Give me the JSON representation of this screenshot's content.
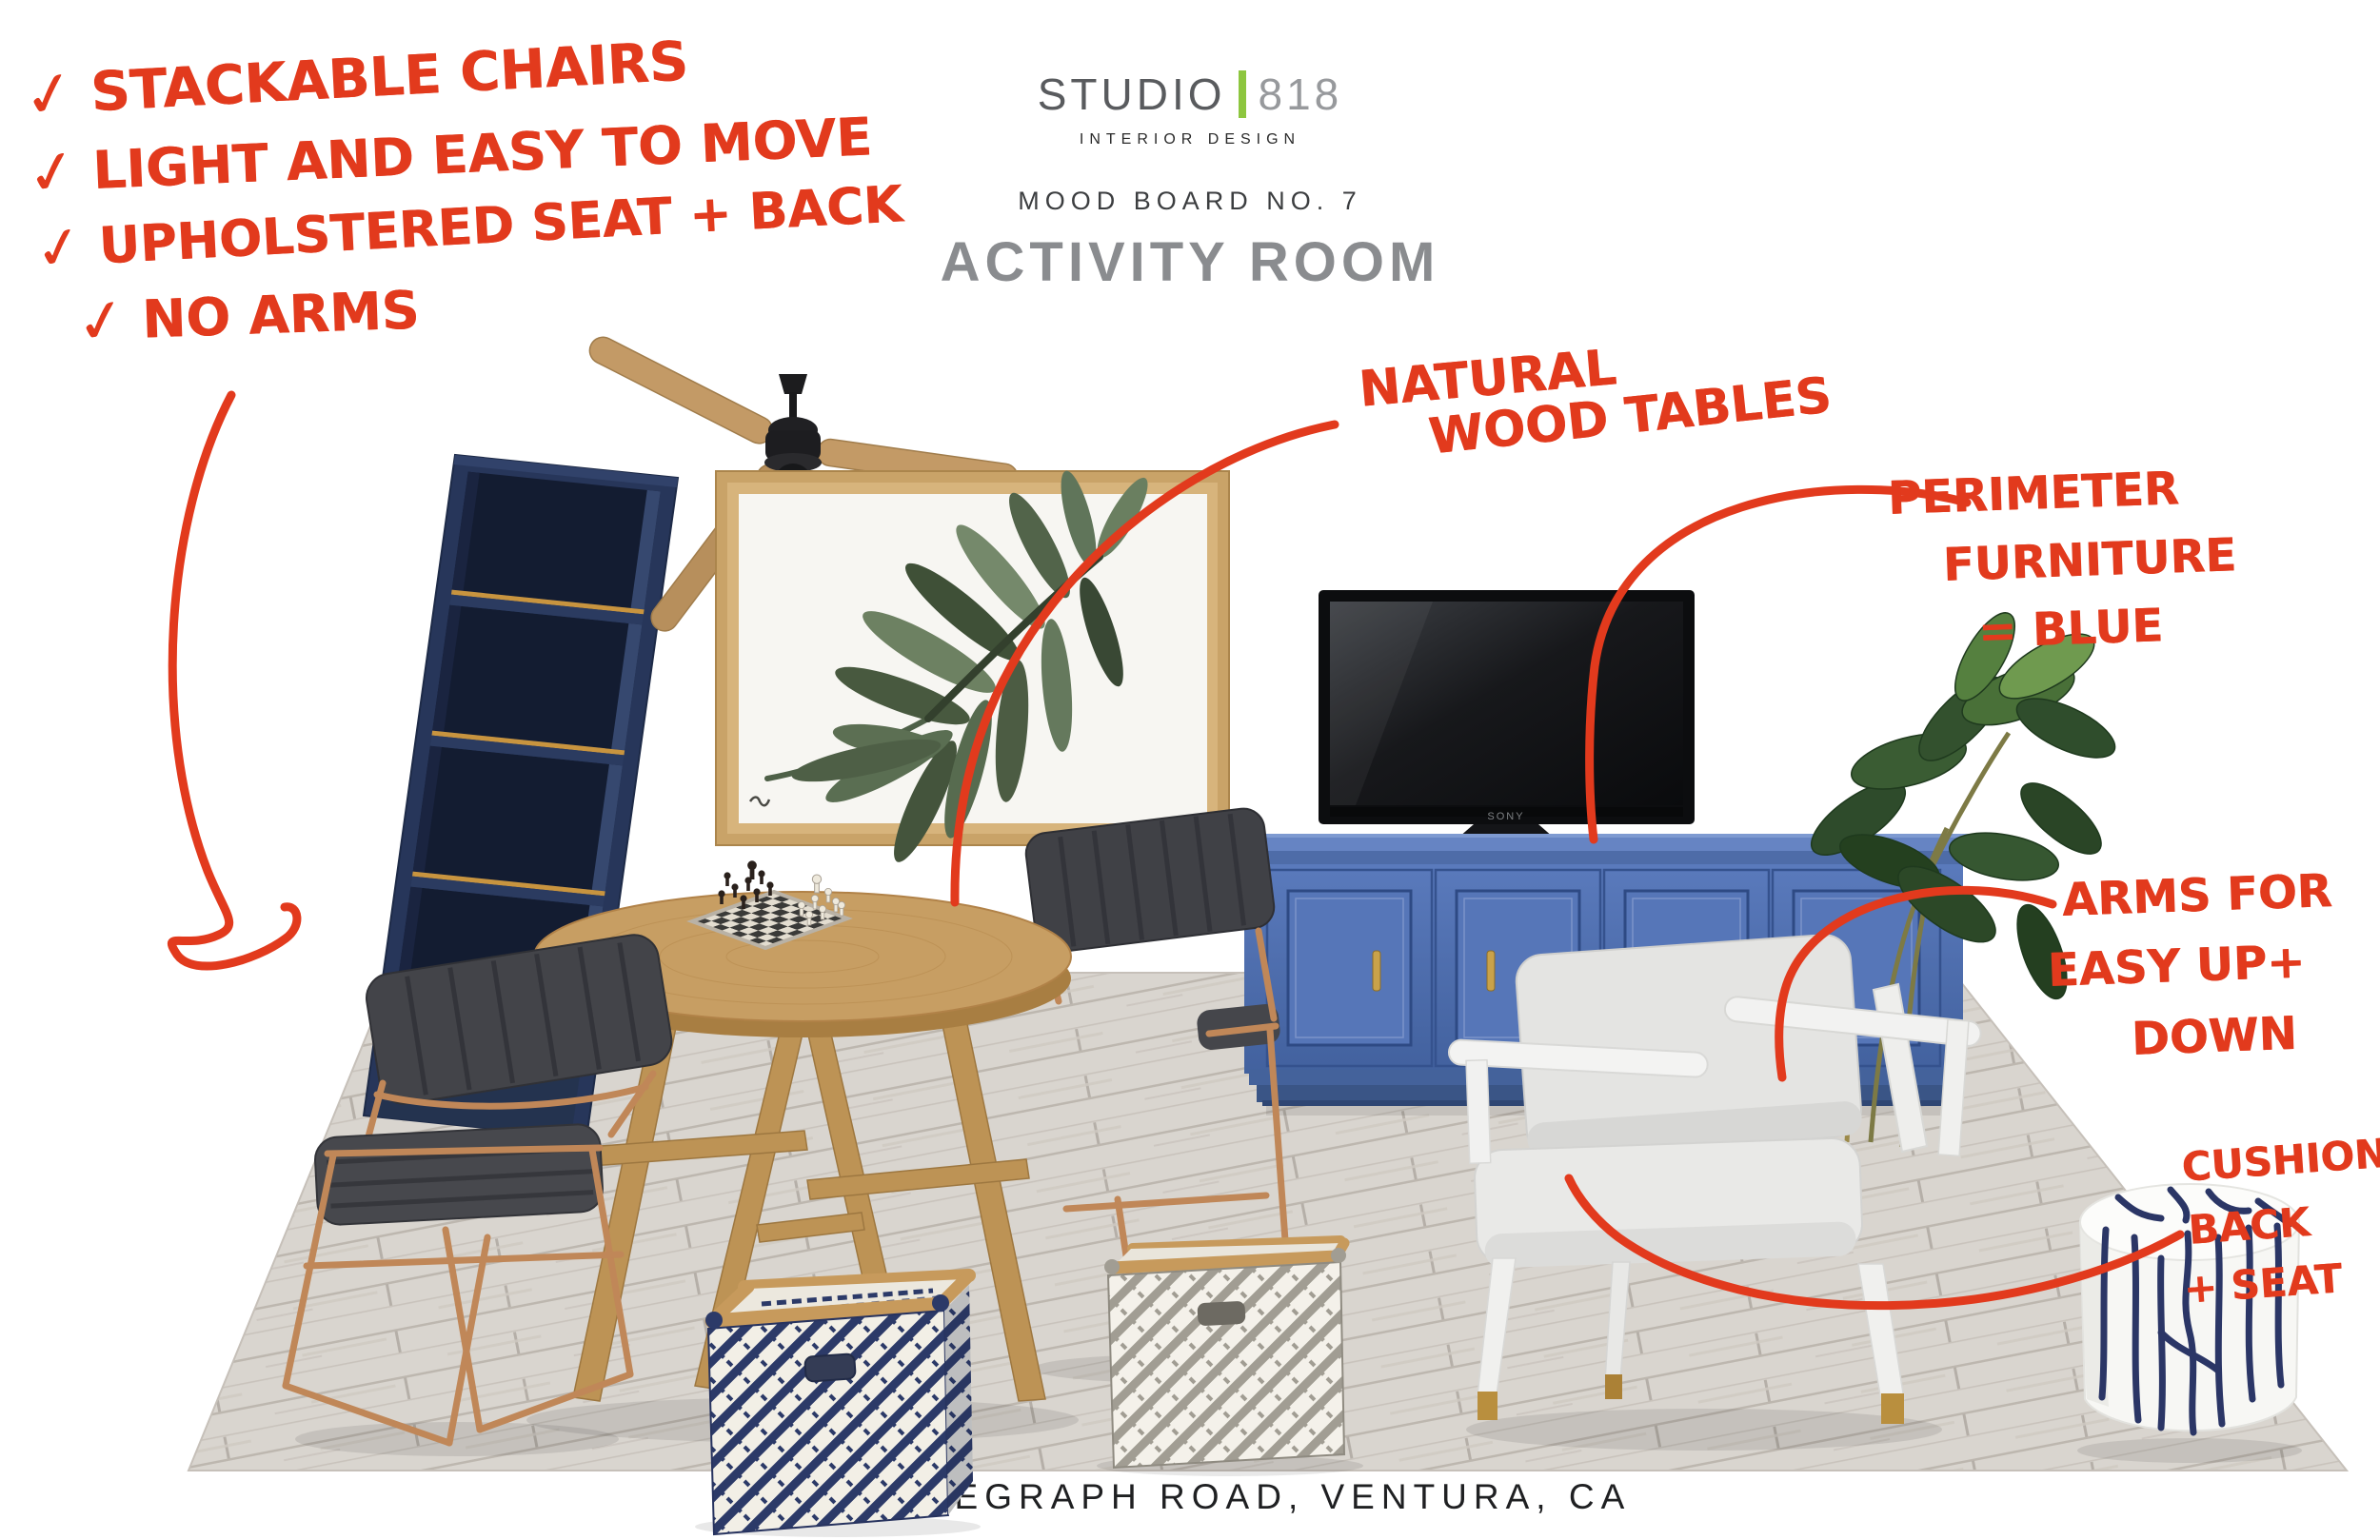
{
  "header": {
    "brand_name": "STUDIO",
    "brand_number": "818",
    "brand_tagline": "INTERIOR DESIGN",
    "board_label": "MOOD BOARD NO. 7",
    "room_title": "ACTIVITY ROOM",
    "accent_green": "#8dc63f"
  },
  "annotations": {
    "ink_color": "#e23a1d",
    "checklist": [
      {
        "check": "✓",
        "text": "STACKABLE CHAIRS"
      },
      {
        "check": "✓",
        "text": "LIGHT AND EASY TO MOVE"
      },
      {
        "check": "✓",
        "text": "UPHOLSTERED SEAT + BACK"
      },
      {
        "check": "✓",
        "text": "NO ARMS"
      }
    ],
    "notes": {
      "natural": {
        "lines": [
          "NATURAL",
          "WOOD TABLES"
        ]
      },
      "perimeter": {
        "lines": [
          "PERIMETER",
          "FURNITURE",
          "= BLUE"
        ]
      },
      "arms": {
        "lines": [
          "ARMS FOR",
          "EASY UP+",
          "DOWN"
        ]
      },
      "cushion": {
        "lines": [
          "CUSHION",
          "BACK",
          "+ SEAT"
        ]
      }
    }
  },
  "tv": {
    "brand_label": "SONY"
  },
  "footer": {
    "address": "5430 TELEGRAPH ROAD, VENTURA, CA"
  },
  "palette": {
    "ink_red": "#e23a1d",
    "accent_green": "#8dc63f",
    "navy_shelf": "#27365a",
    "gold_trim": "#c8943f",
    "credenza_blue": "#4b6db0",
    "table_wood": "#c59e66",
    "floor_gray_wood": "#d8d4ce",
    "chair_charcoal": "#45464c",
    "copper_frame": "#c08758",
    "armchair_white": "#f2f2f1",
    "leaf_green": "#5c6f53",
    "stool_navy": "#2b3666"
  },
  "board_items": [
    "navy bookshelf with gold trim",
    "wood blade ceiling fan",
    "framed palm leaf art",
    "flat screen tv",
    "blue four door credenza",
    "rubber tree plant",
    "charcoal stacking chairs with copper frames",
    "round natural wood game table",
    "chess set",
    "white frame lounge chair with gray cushions",
    "white and navy garden stool",
    "woven storage baskets",
    "light gray wood floor"
  ]
}
